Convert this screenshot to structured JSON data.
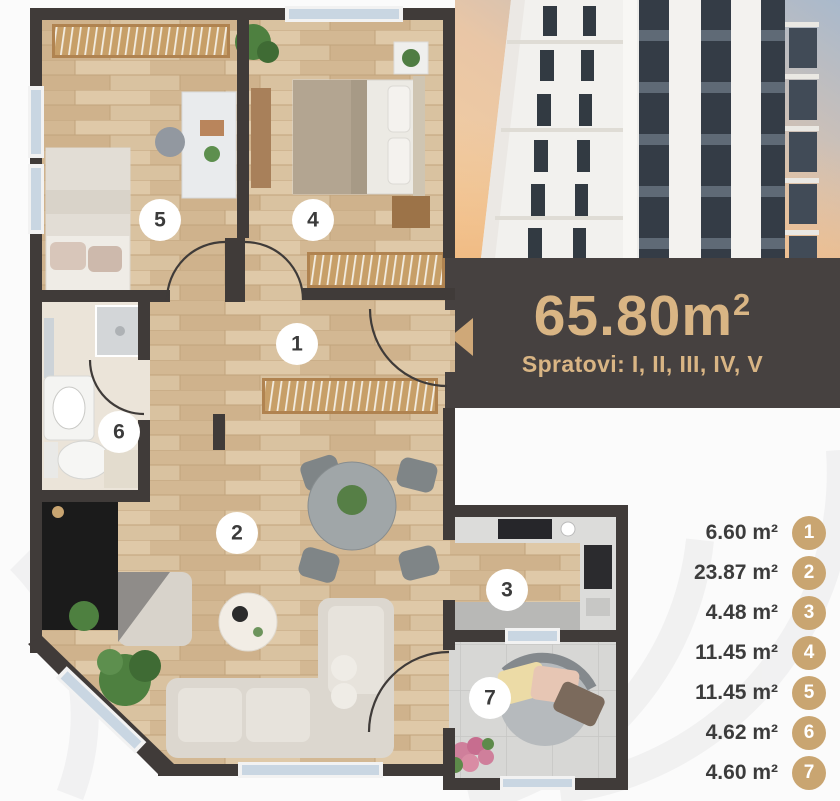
{
  "banner": {
    "area_value": "65.80m",
    "area_sup": "2",
    "floors_label": "Spratovi: I, II, III, IV, V"
  },
  "legend": {
    "items": [
      {
        "number": "1",
        "area": "6.60 m²"
      },
      {
        "number": "2",
        "area": "23.87 m²"
      },
      {
        "number": "3",
        "area": "4.48 m²"
      },
      {
        "number": "4",
        "area": "11.45 m²"
      },
      {
        "number": "5",
        "area": "11.45 m²"
      },
      {
        "number": "6",
        "area": "4.62 m²"
      },
      {
        "number": "7",
        "area": "4.60 m²"
      }
    ]
  },
  "icons": {
    "entrance_arrow": "left-triangle"
  },
  "colors": {
    "accent": "#cfa878",
    "badge": "#c9a571",
    "band_bg": "#464140",
    "wall": "#403b39",
    "title_text": "#d9b584",
    "wood_floor": "#d9c2a0",
    "window_glass": "#c9d6e2"
  }
}
